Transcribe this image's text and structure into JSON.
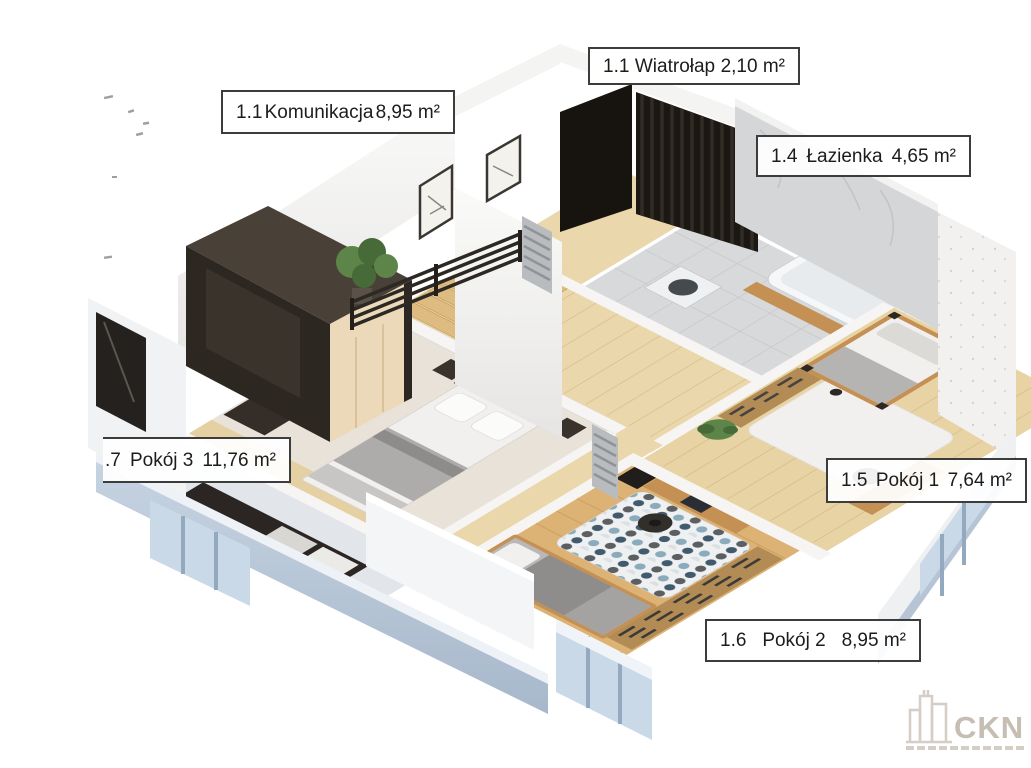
{
  "page": {
    "background": "#ffffff",
    "type": "3D isometric floor-plan render of an apartment upper storey"
  },
  "labels": [
    {
      "number": "1.1",
      "name": "Wiatrołap",
      "area": "2,10 m²"
    },
    {
      "number": "1.1",
      "name": "Komunikacja",
      "area": "8,95 m²"
    },
    {
      "number": "1.4",
      "name": "Łazienka",
      "area": "4,65 m²"
    },
    {
      "number": ".7",
      "name": "Pokój 3",
      "area": "11,76 m²"
    },
    {
      "number": "1.5",
      "name": "Pokój 1",
      "area": "7,64 m²"
    },
    {
      "number": "1.6",
      "name": "Pokój 2",
      "area": "8,95 m²"
    }
  ],
  "watermark": {
    "brand": "CKN"
  },
  "palette": {
    "page_bg": "#ffffff",
    "label_border": "#3c3c3c",
    "label_text": "#1c1c1c",
    "wall_white": "#f6f5f3",
    "wall_shade": "#e7e6e4",
    "carpet": "#e8e2d8",
    "wood_light": "#ead7ab",
    "wood_warm": "#ddb275",
    "wood_furniture": "#c49053",
    "dark": "#2b2623",
    "near_black": "#17130f",
    "exterior_blue": "#b6c4d5",
    "exterior_light": "#e7edf4",
    "marble": "#d5d6d8",
    "tile": "#d8d9db",
    "plant_green": "#5d8549",
    "plant_dark": "#476b38",
    "bed_gray": "#aeacaa",
    "bedding_white": "#f1f0ee",
    "rug_white": "#eef0f2",
    "rug_navy": "#2e4a5e",
    "rug_blue": "#7fa3b5",
    "rug_gray": "#4c4f52",
    "radiator": "#b9bcbf",
    "glass": "#c9d9e8",
    "frame_blue": "#93a9c0",
    "logo_gray": "#c6bdb3",
    "logo_light": "#d5cec6"
  }
}
